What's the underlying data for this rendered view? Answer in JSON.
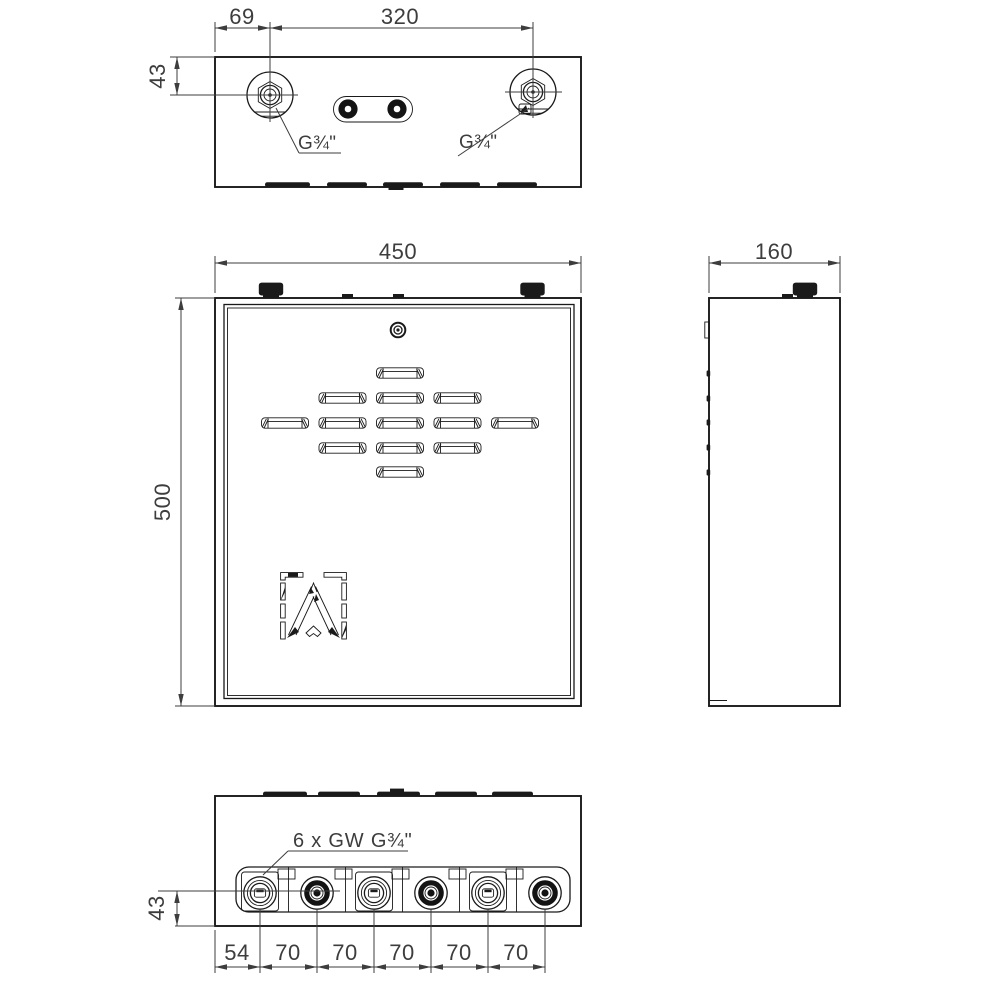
{
  "drawing": {
    "colors": {
      "line": "#1a1a1a",
      "dim": "#3d3d3d",
      "background": "#ffffff"
    },
    "top_view": {
      "dim_offset_left": "69",
      "dim_port_spacing": "320",
      "dim_port_inset": "43",
      "port_label_left": "G¾\"",
      "port_label_right": "G¾\""
    },
    "front_view": {
      "dim_width": "450",
      "dim_height": "500"
    },
    "side_view": {
      "dim_depth": "160"
    },
    "bottom_view": {
      "connection_callout": "6 x GW G¾\"",
      "dim_port_height": "43",
      "dim_first_port": "54",
      "dim_port_pitch": [
        "70",
        "70",
        "70",
        "70",
        "70"
      ]
    }
  }
}
